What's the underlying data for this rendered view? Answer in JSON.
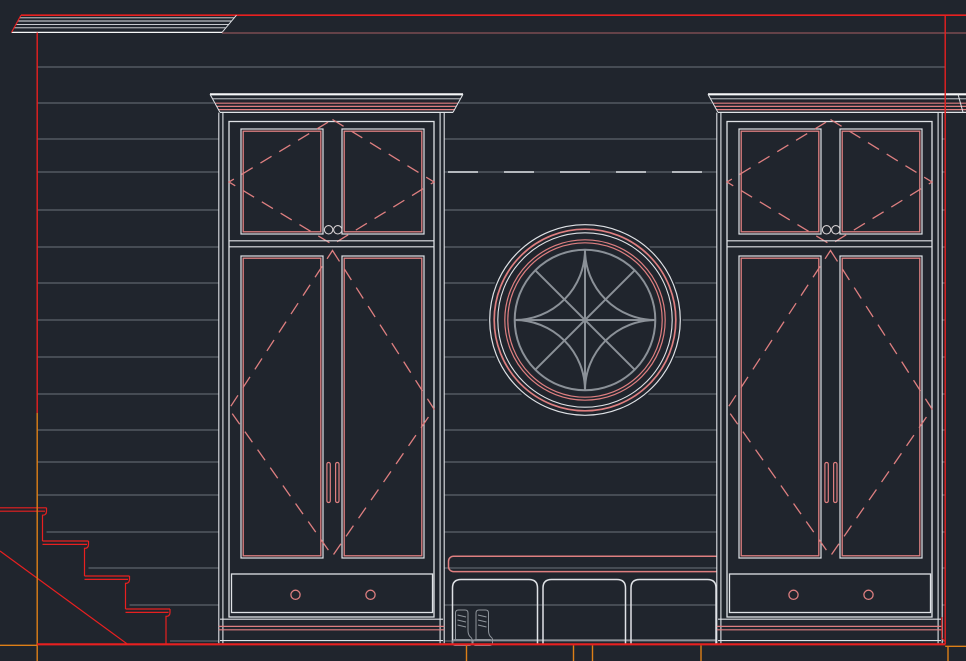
{
  "meta": {
    "title": "CAD model-space viewport — interior elevation of mudroom built-in cabinetry",
    "drawing_type": "2D elevation linework",
    "units": "pixels"
  },
  "canvas": {
    "width": 966,
    "height": 661
  },
  "colors": {
    "bg": "#20252d",
    "red": "#e82020",
    "salmon": "#de7f80",
    "dimsalmon": "#a85f63",
    "white": "#dfe2e6",
    "brightwhite": "#f7f8f9",
    "gray": "#6d737b",
    "muntin": "#8b9198",
    "orange": "#dd7f17",
    "knob": "#d6d0d2",
    "boots": "#8f959c",
    "datum": "#e6e9ed"
  },
  "layers": [
    {
      "name": "walls-structure",
      "color_key": "red"
    },
    {
      "name": "cabinet-faces",
      "color_key": "white"
    },
    {
      "name": "door-panels-and-swings",
      "color_key": "salmon"
    },
    {
      "name": "wall-siding",
      "color_key": "gray"
    },
    {
      "name": "window-muntins",
      "color_key": "muntin"
    },
    {
      "name": "datum-extension-lines",
      "color_key": "orange"
    }
  ],
  "components": {
    "siding_courses": 17,
    "staircase": {
      "steps": 4,
      "side": "left",
      "stringer": "diagonal"
    },
    "ceiling_crown": {
      "present": true
    },
    "cabinets": [
      {
        "id": "left-cabinet",
        "upper_doors": 2,
        "lower_doors": 2,
        "drawers": 1,
        "upper_knobs": 2,
        "drawer_knobs": 2,
        "door_pulls": 2,
        "crown": true
      },
      {
        "id": "right-cabinet",
        "upper_doors": 2,
        "lower_doors": 2,
        "drawers": 1,
        "upper_knobs": 2,
        "drawer_knobs": 2,
        "door_pulls": 2,
        "crown": true
      }
    ],
    "round_window": {
      "shape": "circle",
      "trim_rings": 5,
      "muntin_pattern": "curved lattice with diagonals"
    },
    "bench": {
      "seat": true,
      "open_cubbies": 3
    },
    "icons": [
      {
        "name": "boots-icon",
        "location": "left cubby"
      }
    ],
    "datum_ticks_below_floor": 6
  }
}
